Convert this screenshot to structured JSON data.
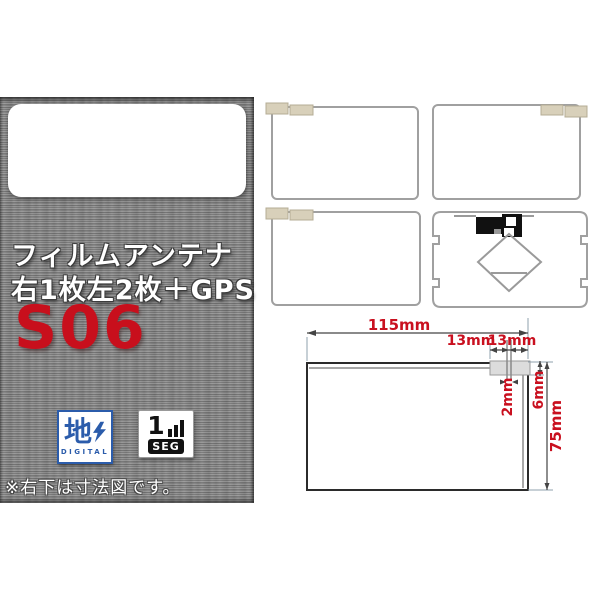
{
  "left_panel": {
    "texture_color": "#8e8e8e",
    "headline_line1": "フィルムアンテナ",
    "headline_line2": "右1枚左2枚＋GPS",
    "model_code": "S06",
    "model_color": "#c80f1c",
    "note": "※右下は寸法図です。",
    "logos": {
      "digital": {
        "kanji": "地",
        "label": "DIGITAL",
        "color": "#2b5cab"
      },
      "oneseg": {
        "digit": "1",
        "label": "SEG",
        "color": "#111111"
      }
    }
  },
  "diagrams": {
    "film_tab_color": "#d8d0ba",
    "outline_color": "#a0a0a0",
    "items": [
      "film-antenna-top-left",
      "film-antenna-top-right",
      "film-antenna-bottom-left",
      "gps-film-antenna"
    ]
  },
  "dimension_diagram": {
    "label_color": "#c9101f",
    "labels": {
      "width_total": "115mm",
      "tab_left": "13mm",
      "tab_right": "13mm",
      "element_gap": "2mm",
      "tab_height": "6mm",
      "height_total": "75mm"
    }
  }
}
